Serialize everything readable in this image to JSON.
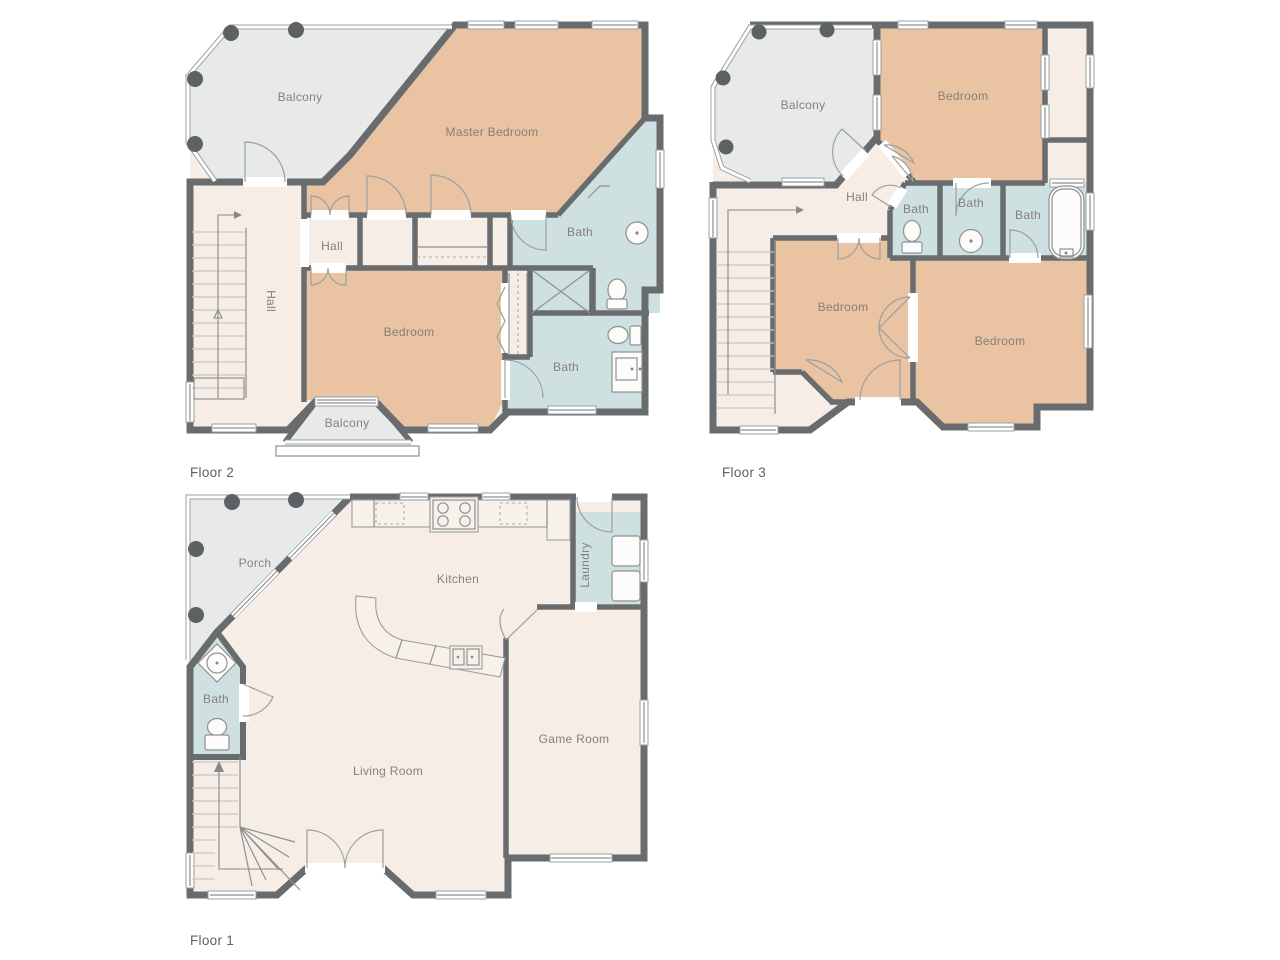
{
  "colors": {
    "wall": "#686c6f",
    "room_bedroom": "#e9c3a2",
    "room_bath": "#cfe0e0",
    "room_neutral": "#f6ede6",
    "room_outdoor": "#e8eaea",
    "counter": "#f8f1ea",
    "fixture": "#fdfcfa",
    "line": "#8d9192",
    "railing": "#9aa0a0",
    "column": "#5d6164",
    "label_text": "#87807a",
    "floor_label_text": "#5d6266"
  },
  "floors": {
    "floor2": {
      "label": "Floor 2",
      "rooms": {
        "balcony": "Balcony",
        "master_bedroom": "Master Bedroom",
        "bath_top": "Bath",
        "hall_small": "Hall",
        "hall": "Hall",
        "bedroom": "Bedroom",
        "bath_bottom": "Bath",
        "balcony_small": "Balcony"
      }
    },
    "floor3": {
      "label": "Floor 3",
      "rooms": {
        "balcony": "Balcony",
        "bedroom_top": "Bedroom",
        "hall": "Hall",
        "bath_left": "Bath",
        "bath_mid": "Bath",
        "bath_right": "Bath",
        "bedroom_left": "Bedroom",
        "bedroom_right": "Bedroom"
      }
    },
    "floor1": {
      "label": "Floor 1",
      "rooms": {
        "porch": "Porch",
        "kitchen": "Kitchen",
        "laundry": "Laundry",
        "bath": "Bath",
        "living_room": "Living Room",
        "game_room": "Game Room"
      }
    }
  }
}
